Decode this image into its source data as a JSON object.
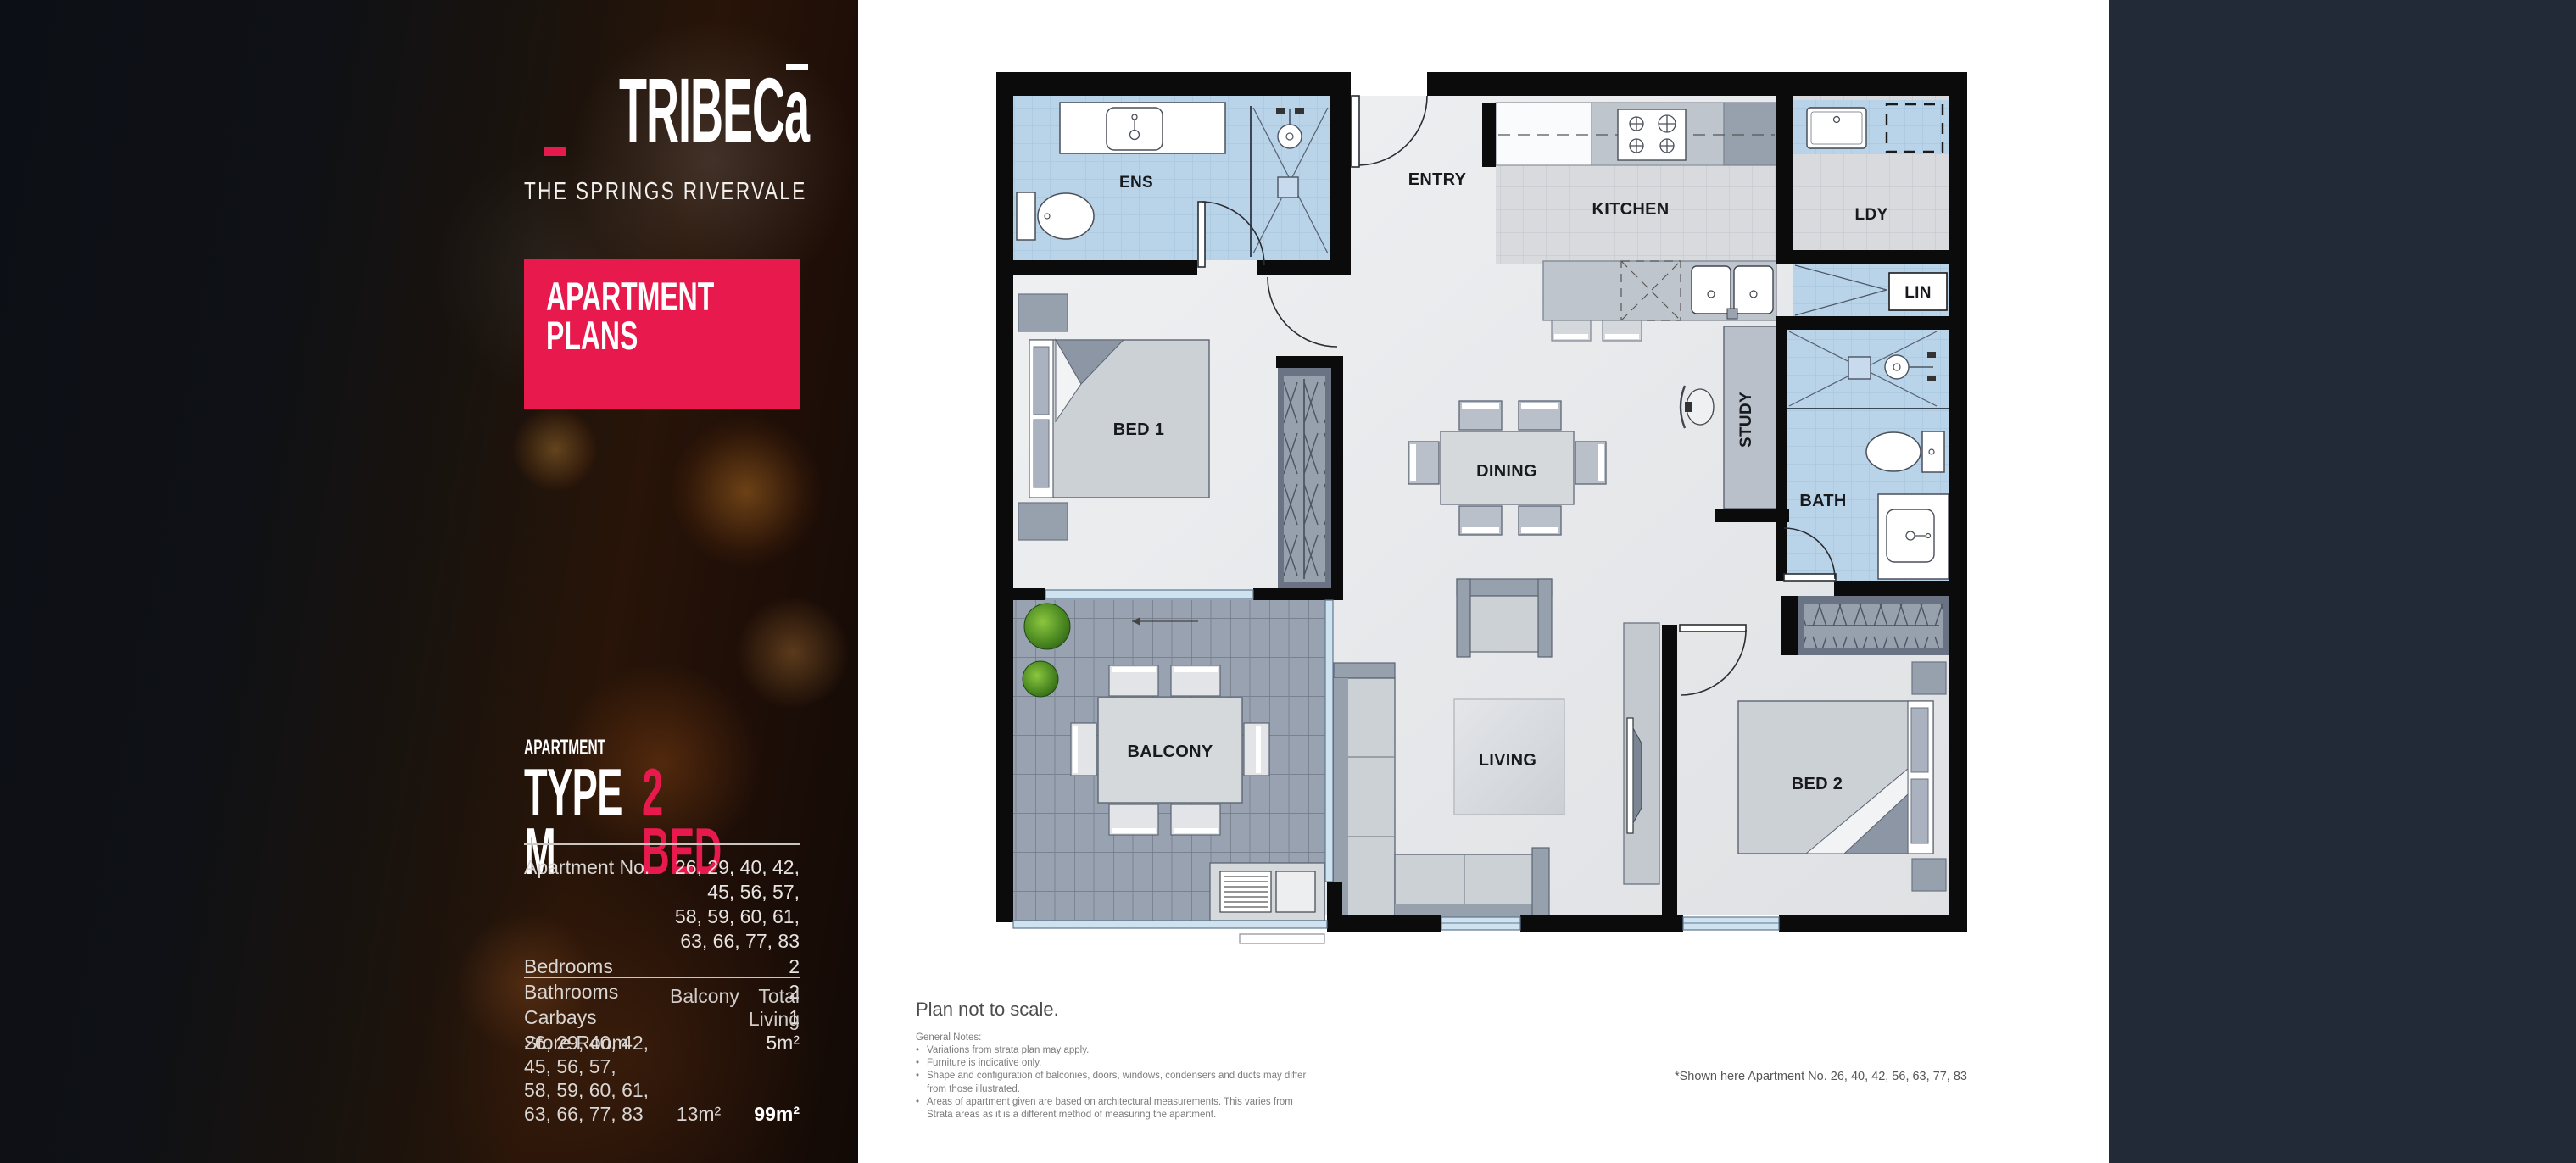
{
  "sidebar": {
    "logo": {
      "brand_left_main": "TRIBEC",
      "brand_left_accent": "a",
      "brand_right_main": "EAS",
      "brand_right_accent": "T",
      "tagline": "THE SPRINGS RIVERVALE"
    },
    "banner": {
      "line1": "APARTMENT",
      "line2": "PLANS"
    },
    "type": {
      "eyebrow": "APARTMENT",
      "name": "TYPE M",
      "beds": "2 BED"
    },
    "specs": {
      "rows": [
        {
          "label": "Apartment No.",
          "value": "26, 29, 40, 42, 45, 56, 57,\n58, 59, 60, 61, 63, 66, 77, 83"
        },
        {
          "label": "Bedrooms",
          "value": "2"
        },
        {
          "label": "Bathrooms",
          "value": "2"
        },
        {
          "label": "Carbays",
          "value": "1"
        },
        {
          "label": "Store Room",
          "value": "5m²"
        }
      ]
    },
    "areas": {
      "col_balcony": "Balcony",
      "col_total": "Total Living",
      "row_label": "26, 29, 40, 42, 45, 56, 57,\n58, 59, 60, 61, 63, 66, 77, 83",
      "balcony_value": "13m²",
      "total_value": "99m²"
    }
  },
  "plan": {
    "rooms": [
      {
        "id": "ens",
        "label": "ENS"
      },
      {
        "id": "entry",
        "label": "ENTRY"
      },
      {
        "id": "kitchen",
        "label": "KITCHEN"
      },
      {
        "id": "ldy",
        "label": "LDY"
      },
      {
        "id": "lin",
        "label": "LIN"
      },
      {
        "id": "study",
        "label": "STUDY"
      },
      {
        "id": "bath",
        "label": "BATH"
      },
      {
        "id": "dining",
        "label": "DINING"
      },
      {
        "id": "bed1",
        "label": "BED 1"
      },
      {
        "id": "balcony",
        "label": "BALCONY"
      },
      {
        "id": "living",
        "label": "LIVING"
      },
      {
        "id": "bed2",
        "label": "BED 2"
      }
    ]
  },
  "notes": {
    "title": "Plan not to scale.",
    "heading": "General Notes:",
    "bullets": [
      "Variations from strata plan may apply.",
      "Furniture is indicative only.",
      "Shape and configuration of balconies, doors, windows, condensers and ducts may differ from those illustrated.",
      "Areas of apartment given are based on architectural measurements. This varies from Strata areas as it is a different method of measuring the apartment."
    ],
    "shown_here": "*Shown here Apartment No. 26, 40, 42, 56, 63, 77, 83"
  },
  "colors": {
    "accent": "#E8194C",
    "panel_dark": "#222a37",
    "wall": "#0b0b0c"
  }
}
